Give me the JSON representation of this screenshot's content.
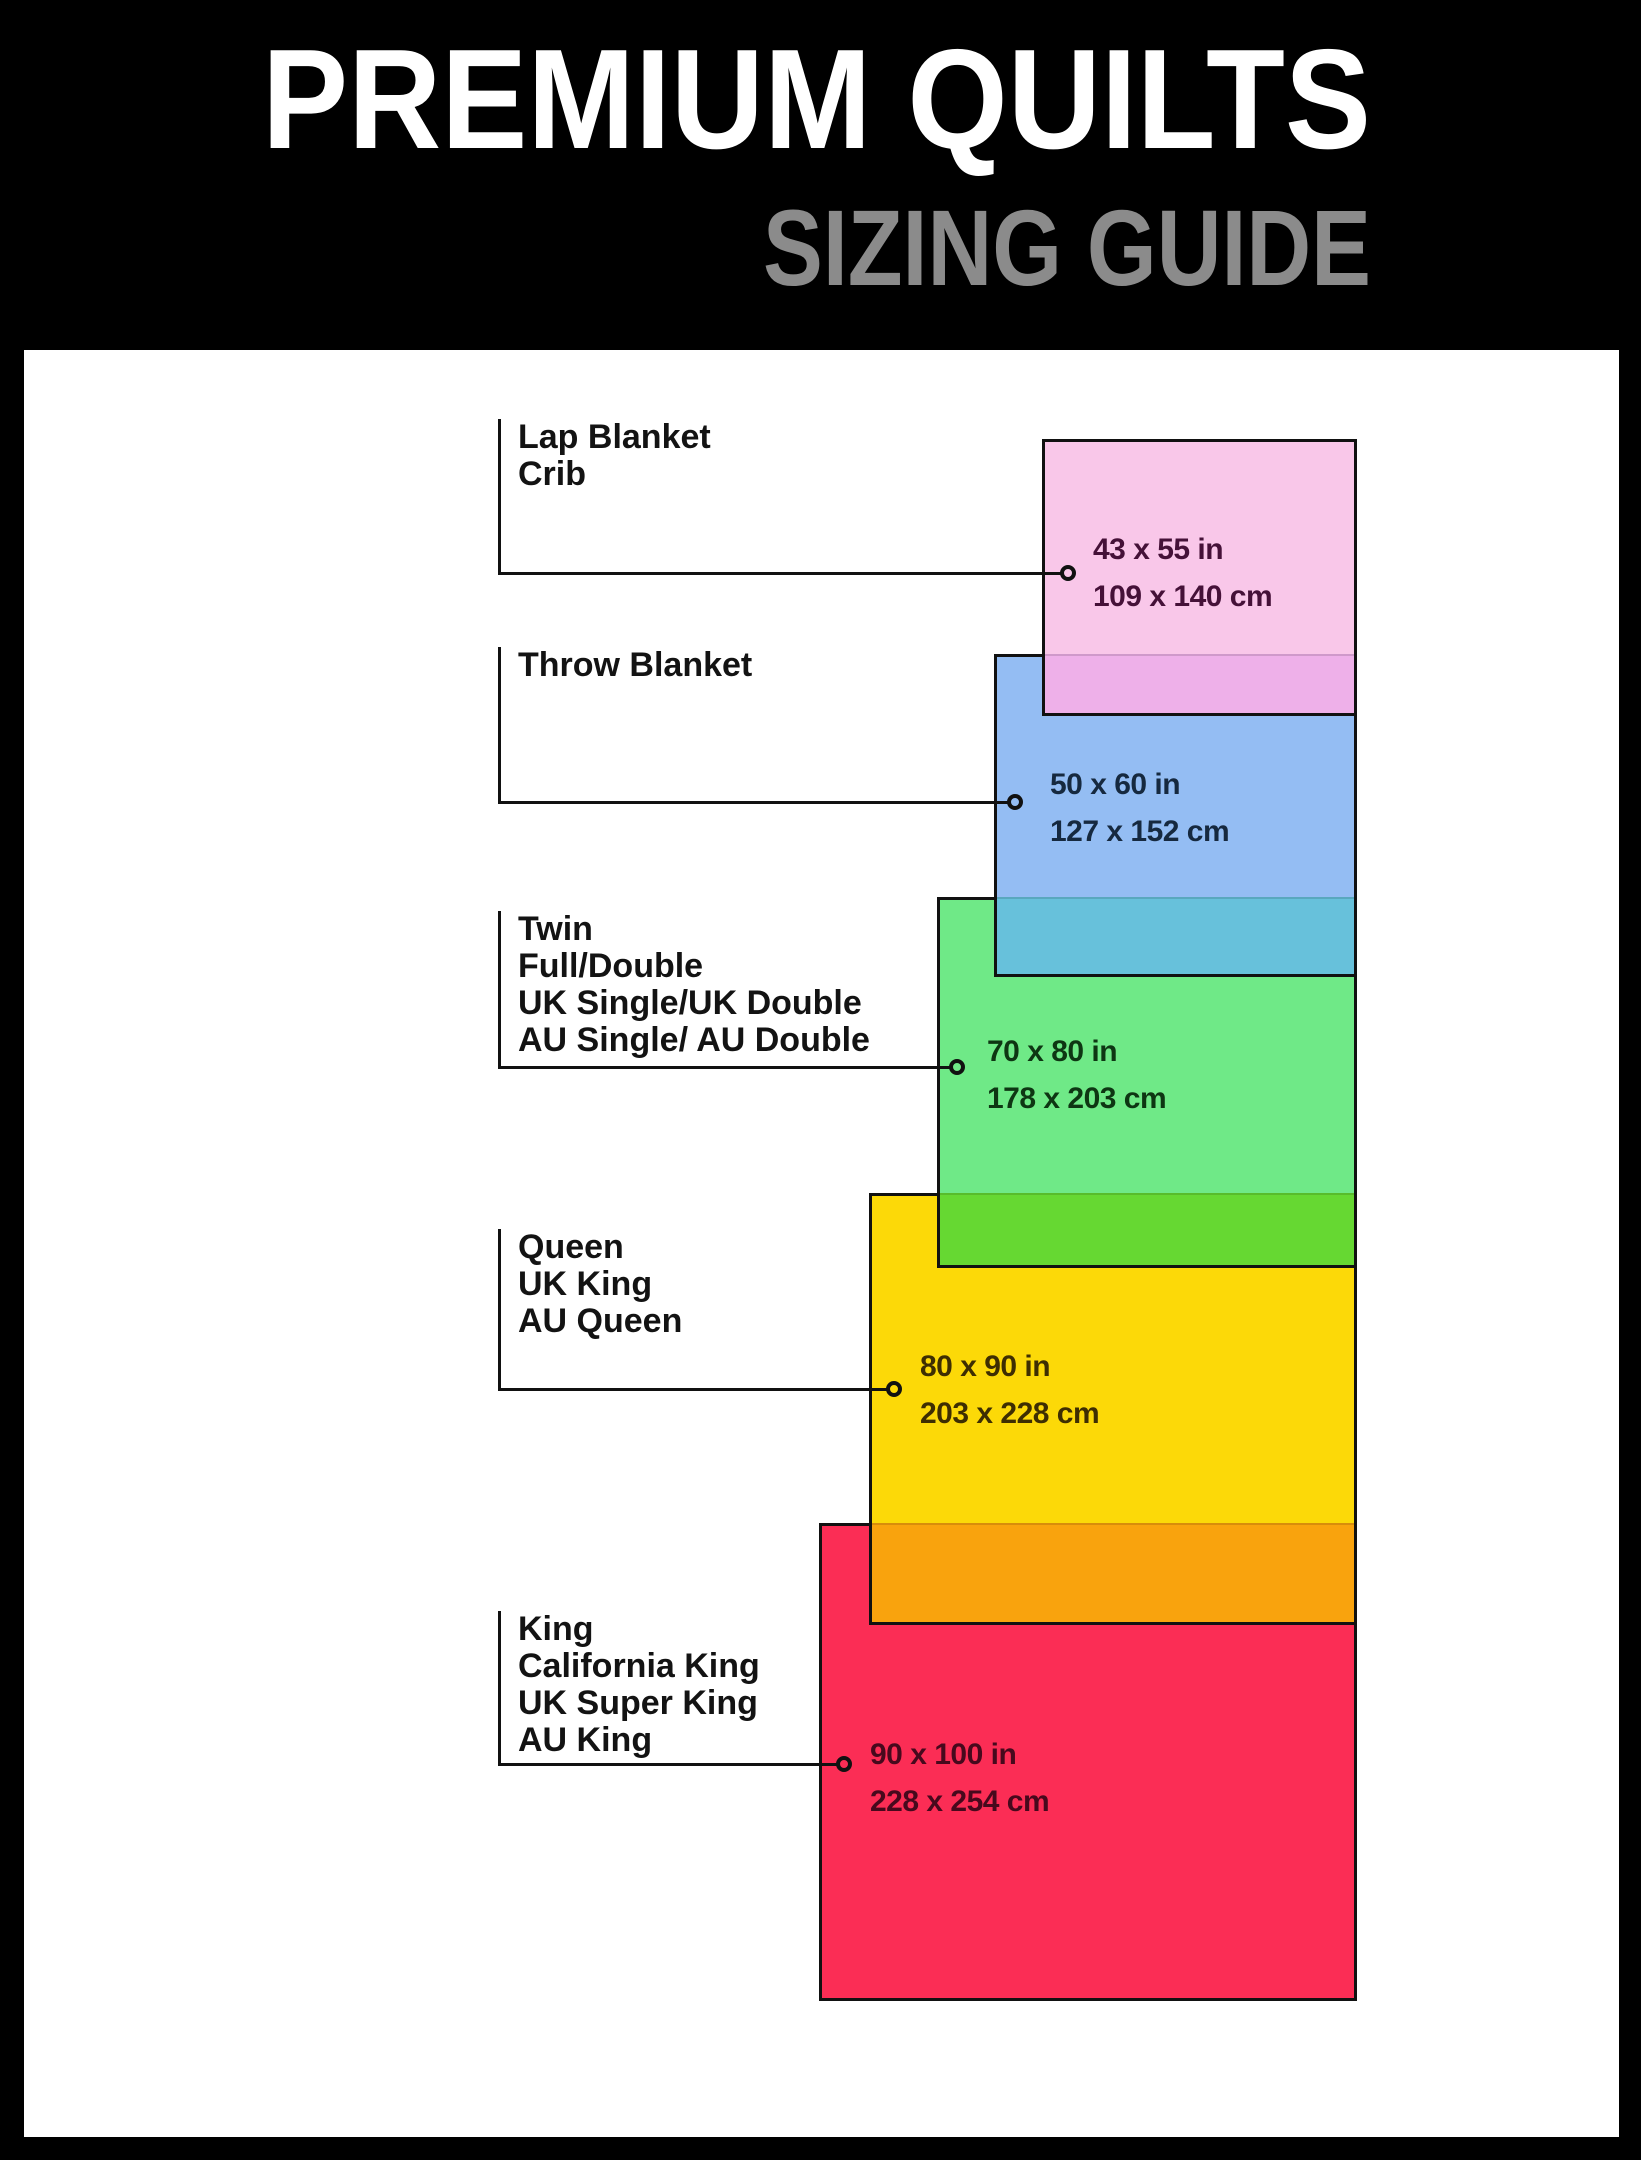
{
  "page": {
    "bg": "#000000",
    "content_bg": "#ffffff"
  },
  "header": {
    "title": "PREMIUM QUILTS",
    "subtitle": "SIZING GUIDE",
    "title_color": "#ffffff",
    "subtitle_color": "#8b8b8b"
  },
  "quilts": [
    {
      "names": [
        "Lap Blanket",
        "Crib"
      ],
      "size_in": "43 x 55 in",
      "size_cm": "109 x 140 cm",
      "fill": "#f9c7e9",
      "overlap_fill": "#eeb0e9",
      "text_color": "#451138"
    },
    {
      "names": [
        "Throw Blanket"
      ],
      "size_in": "50 x 60 in",
      "size_cm": "127 x 152 cm",
      "fill": "#94bdf3",
      "overlap_fill": "#67c1db",
      "text_color": "#16293f"
    },
    {
      "names": [
        "Twin",
        "Full/Double",
        "UK Single/UK Double",
        "AU Single/ AU Double"
      ],
      "size_in": "70 x 80 in",
      "size_cm": "178 x 203 cm",
      "fill": "#6fe987",
      "overlap_fill": "#66d832",
      "text_color": "#0e3613"
    },
    {
      "names": [
        "Queen",
        "UK King",
        "AU Queen"
      ],
      "size_in": "80 x 90 in",
      "size_cm": "203 x 228 cm",
      "fill": "#fcd908",
      "overlap_fill": "#f9a30d",
      "text_color": "#3e2e02"
    },
    {
      "names": [
        "King",
        "California King",
        "UK Super King",
        "AU King"
      ],
      "size_in": "90 x 100 in",
      "size_cm": "228 x 254 cm",
      "fill": "#fb2d55",
      "overlap_fill": null,
      "text_color": "#47091d"
    }
  ]
}
